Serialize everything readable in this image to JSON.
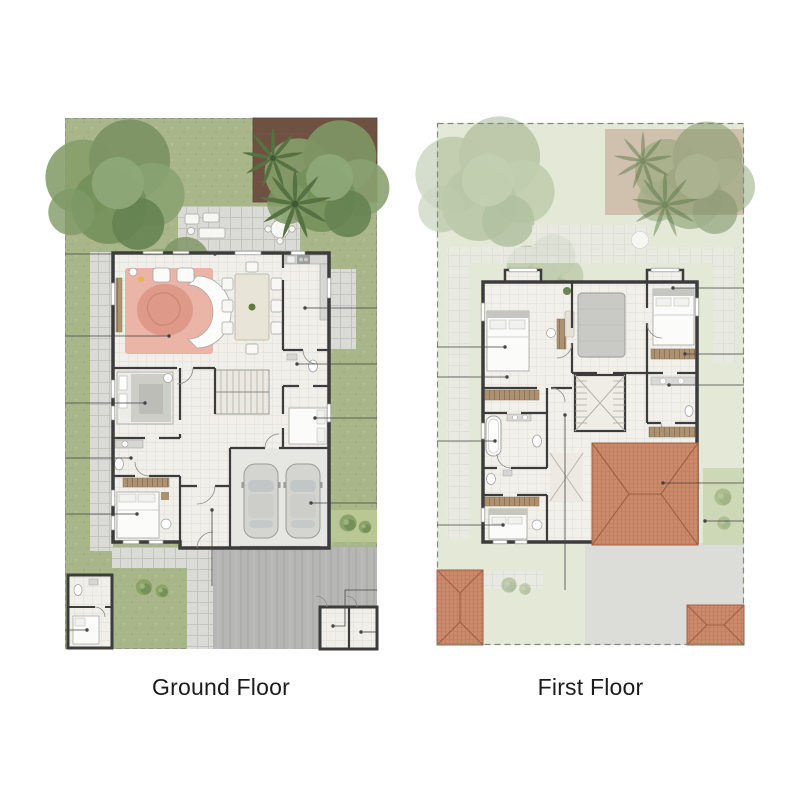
{
  "page": {
    "background": "#ffffff"
  },
  "panels": [
    {
      "id": "ground-floor",
      "label": "Ground Floor"
    },
    {
      "id": "first-floor",
      "label": "First Floor"
    }
  ],
  "palette": {
    "page-bg": "#ffffff",
    "lawn": "#a9b689",
    "lawn-faded": "#e4e8d6",
    "paver": "#dadad6",
    "paver-line": "#c3c3bf",
    "paver-faded": "#ebebe6",
    "driveway": "#b6b6b4",
    "driveway-faded": "#dcdcd9",
    "wall": "#3c3c3c",
    "floor": "#f0efe9",
    "planter": "#6e5140",
    "tree": "#7c9463",
    "palm": "#567242",
    "rug": "#e9b0a3",
    "wood": "#ad9271",
    "roof": "#cd8a6a",
    "roof-line": "#a15f44",
    "label": "#1b1b1b"
  },
  "features": [
    "garden-lawn",
    "trees",
    "palm-trees",
    "planter-bed",
    "outdoor-patio",
    "living-room-rug",
    "curved-sofa",
    "dining-table",
    "kitchen",
    "bedrooms",
    "bathrooms",
    "staircase",
    "double-garage",
    "cars",
    "driveway",
    "maid-room-outbuilding",
    "gate-rooms",
    "hip-roofs",
    "leader-lines",
    "shrubs"
  ]
}
